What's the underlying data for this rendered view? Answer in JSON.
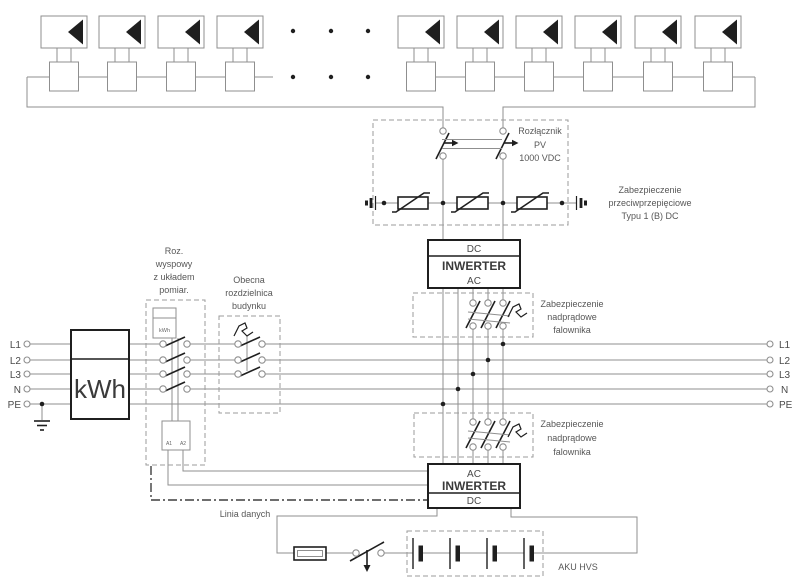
{
  "colors": {
    "wire": "#8f8f8f",
    "black": "#1f1f1f",
    "text": "#575757",
    "background": "#ffffff"
  },
  "pv_array": {
    "left_panels": 4,
    "right_panels": 6
  },
  "labels": {
    "pv_disconnect": [
      "Rozłącznik",
      "PV",
      "1000 VDC"
    ],
    "surge_protection": [
      "Zabezpieczenie",
      "przeciwprzepięciowe",
      "Typu 1 (B) DC"
    ],
    "inverter1": {
      "top": "DC",
      "name": "INWERTER",
      "bottom": "AC"
    },
    "overcurrent_top": [
      "Zabezpieczenie",
      "nadprądowe",
      "falownika"
    ],
    "overcurrent_bottom": [
      "Zabezpieczenie",
      "nadprądowe",
      "falownika"
    ],
    "island_switch": [
      "Roz.",
      "wyspowy",
      "z układem",
      "pomiar."
    ],
    "building_board": [
      "Obecna",
      "rozdzielnica",
      "budynku"
    ],
    "main_meter": "kWh",
    "sub_meter": "kWh",
    "coil_terminals": [
      "A1",
      "A2"
    ],
    "inverter2": {
      "top": "AC",
      "name": "INWERTER",
      "bottom": "DC"
    },
    "data_line": "Linia danych",
    "battery": "AKU HVS",
    "phases_left": [
      "L1",
      "L2",
      "L3",
      "N",
      "PE"
    ],
    "phases_right": [
      "L1",
      "L2",
      "L3",
      "N",
      "PE"
    ]
  }
}
